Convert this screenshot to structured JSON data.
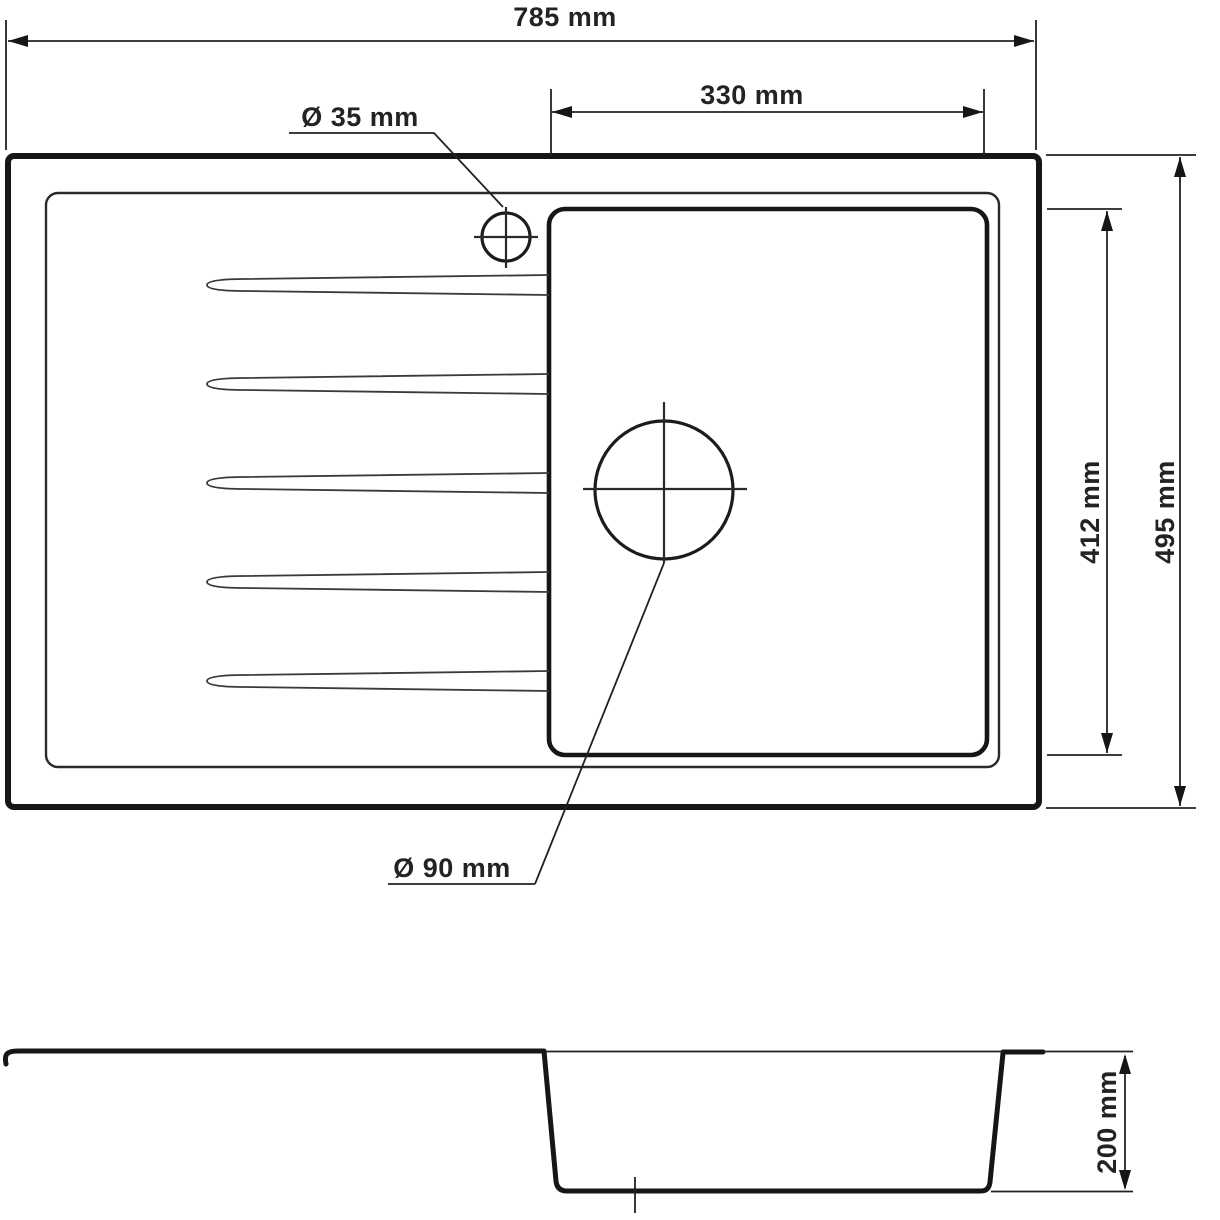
{
  "drawing": {
    "kind": "kitchen sink dimension drawing",
    "background_color": "#ffffff",
    "line_color": "#161616",
    "text_color": "#232323"
  },
  "dimensions": {
    "overall_width": "785 mm",
    "bowl_width": "330 mm",
    "tap_hole_diameter": "Ø 35 mm",
    "drain_diameter": "Ø 90 mm",
    "bowl_length": "412 mm",
    "overall_depth": "495 mm",
    "bowl_depth": "200 mm"
  }
}
